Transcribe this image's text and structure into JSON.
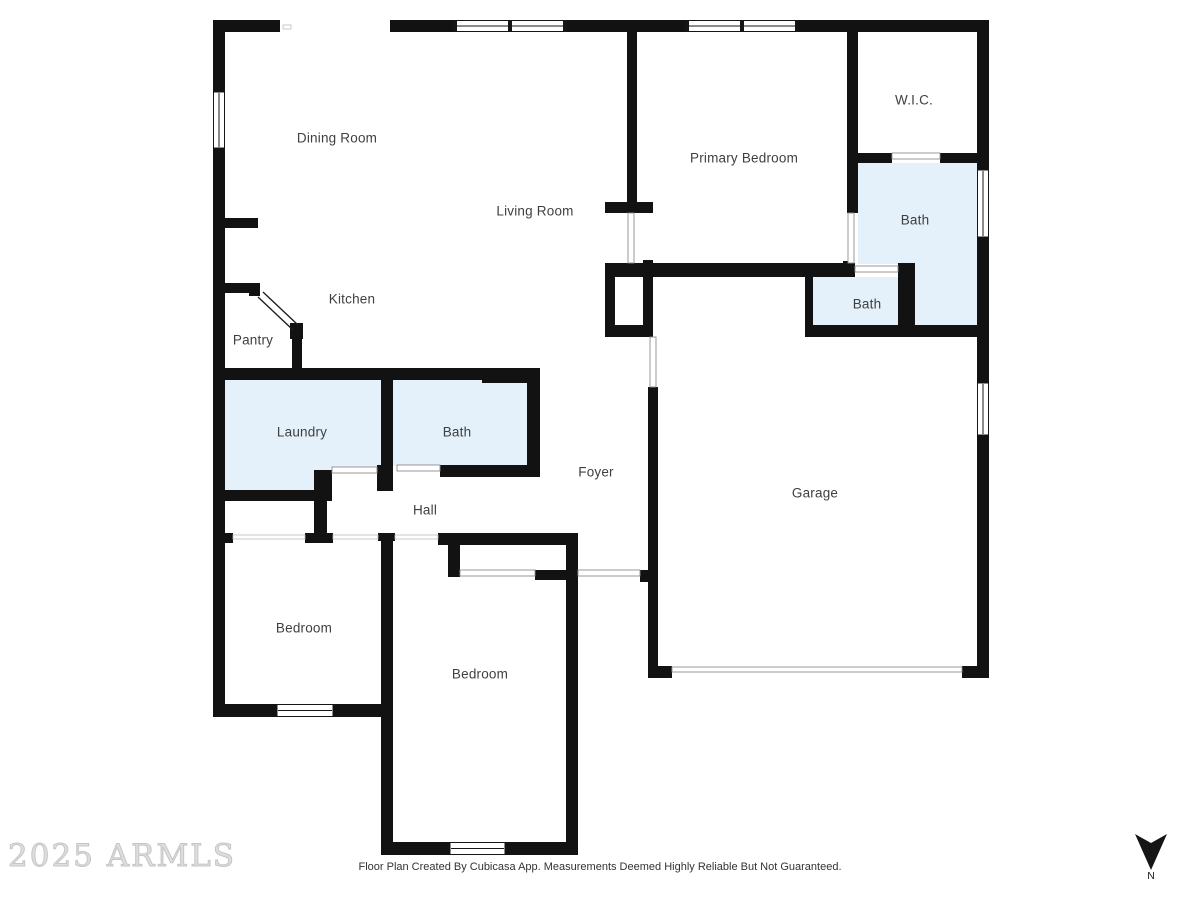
{
  "plan": {
    "rooms": [
      {
        "id": "dining-room",
        "label": "Dining Room"
      },
      {
        "id": "kitchen",
        "label": "Kitchen"
      },
      {
        "id": "pantry",
        "label": "Pantry"
      },
      {
        "id": "living-room",
        "label": "Living Room"
      },
      {
        "id": "primary-bedroom",
        "label": "Primary Bedroom"
      },
      {
        "id": "wic",
        "label": "W.I.C."
      },
      {
        "id": "bath-primary",
        "label": "Bath"
      },
      {
        "id": "bath-water-closet",
        "label": "Bath"
      },
      {
        "id": "laundry",
        "label": "Laundry"
      },
      {
        "id": "bath-hall",
        "label": "Bath"
      },
      {
        "id": "foyer",
        "label": "Foyer"
      },
      {
        "id": "hall",
        "label": "Hall"
      },
      {
        "id": "garage",
        "label": "Garage"
      },
      {
        "id": "bedroom-left",
        "label": "Bedroom"
      },
      {
        "id": "bedroom-middle",
        "label": "Bedroom"
      }
    ]
  },
  "watermark": {
    "text": "2025 ARMLS"
  },
  "footer": {
    "disclaimer": "Floor Plan Created By Cubicasa App. Measurements Deemed Highly Reliable But Not Guaranteed."
  },
  "compass": {
    "north_label": "N"
  },
  "colors": {
    "wall": "#121212",
    "room_highlight": "#e4f0fa",
    "label_text": "#3f3f3f",
    "watermark": "#dedede",
    "footer_text": "#333333"
  }
}
